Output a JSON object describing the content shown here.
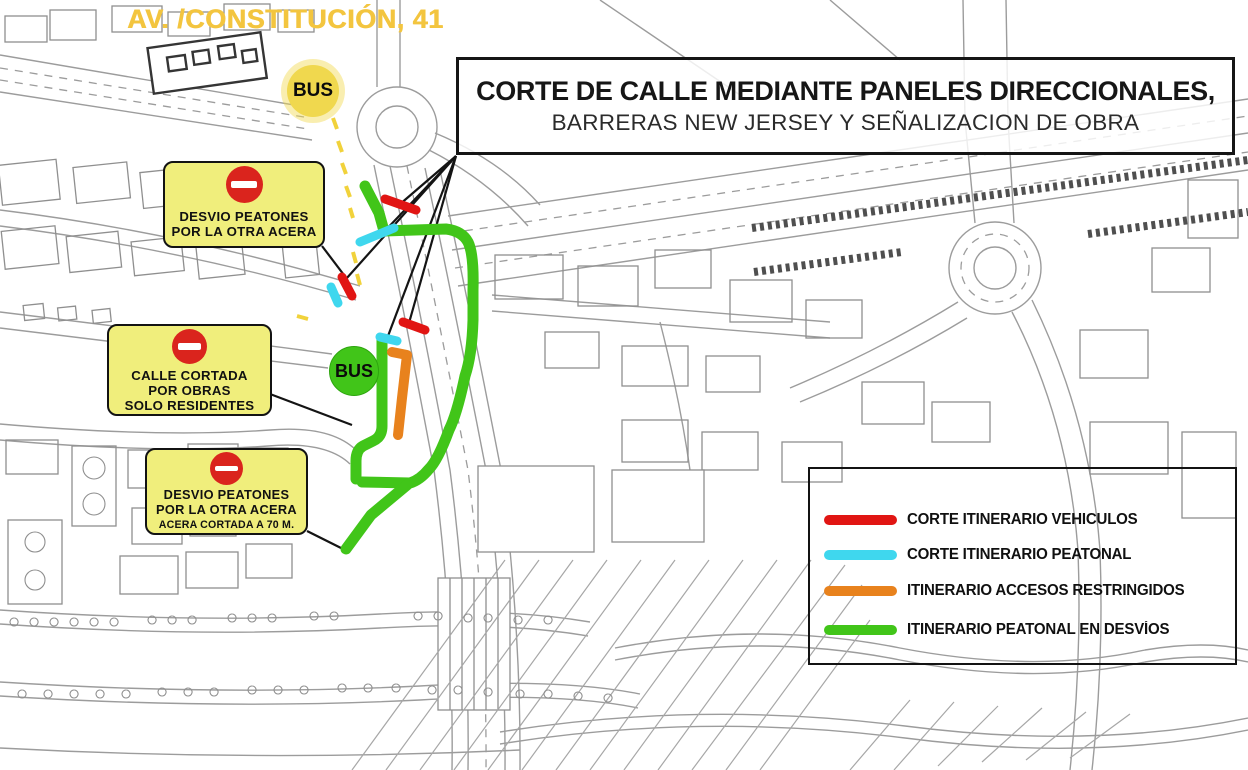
{
  "street_label": "AV. /CONSTITUCIÓN, 41",
  "title_box": {
    "line1": "CORTE DE CALLE MEDIANTE PANELES DIRECCIONALES,",
    "line2": "BARRERAS NEW JERSEY Y SEÑALIZACION DE OBRA"
  },
  "callouts": [
    {
      "lines": [
        "DESVIO PEATONES",
        "POR LA OTRA ACERA"
      ]
    },
    {
      "lines": [
        "CALLE CORTADA",
        "POR OBRAS",
        "SOLO RESIDENTES"
      ]
    },
    {
      "lines": [
        "DESVIO PEATONES",
        "POR LA OTRA ACERA"
      ],
      "note": "ACERA CORTADA A 70 M."
    }
  ],
  "bus_stops": [
    {
      "label": "BUS",
      "marker_color": "#f0d84e"
    },
    {
      "label": "BUS",
      "marker_color": "#41c519"
    }
  ],
  "legend": {
    "items": [
      {
        "label": "CORTE ITINERARIO VEHICULOS",
        "color": "#e11513"
      },
      {
        "label": "CORTE ITINERARIO PEATONAL",
        "color": "#3fd7ee"
      },
      {
        "label": "ITINERARIO ACCESOS RESTRINGIDOS",
        "color": "#e8821d"
      },
      {
        "label": "ITINERARIO PEATONAL EN DESVÍOS",
        "color": "#41c519"
      }
    ]
  },
  "colors": {
    "callout_yellow": "#f0ee7c",
    "no_entry_red": "#da241d",
    "street_label_yellow": "#f3c53f"
  }
}
